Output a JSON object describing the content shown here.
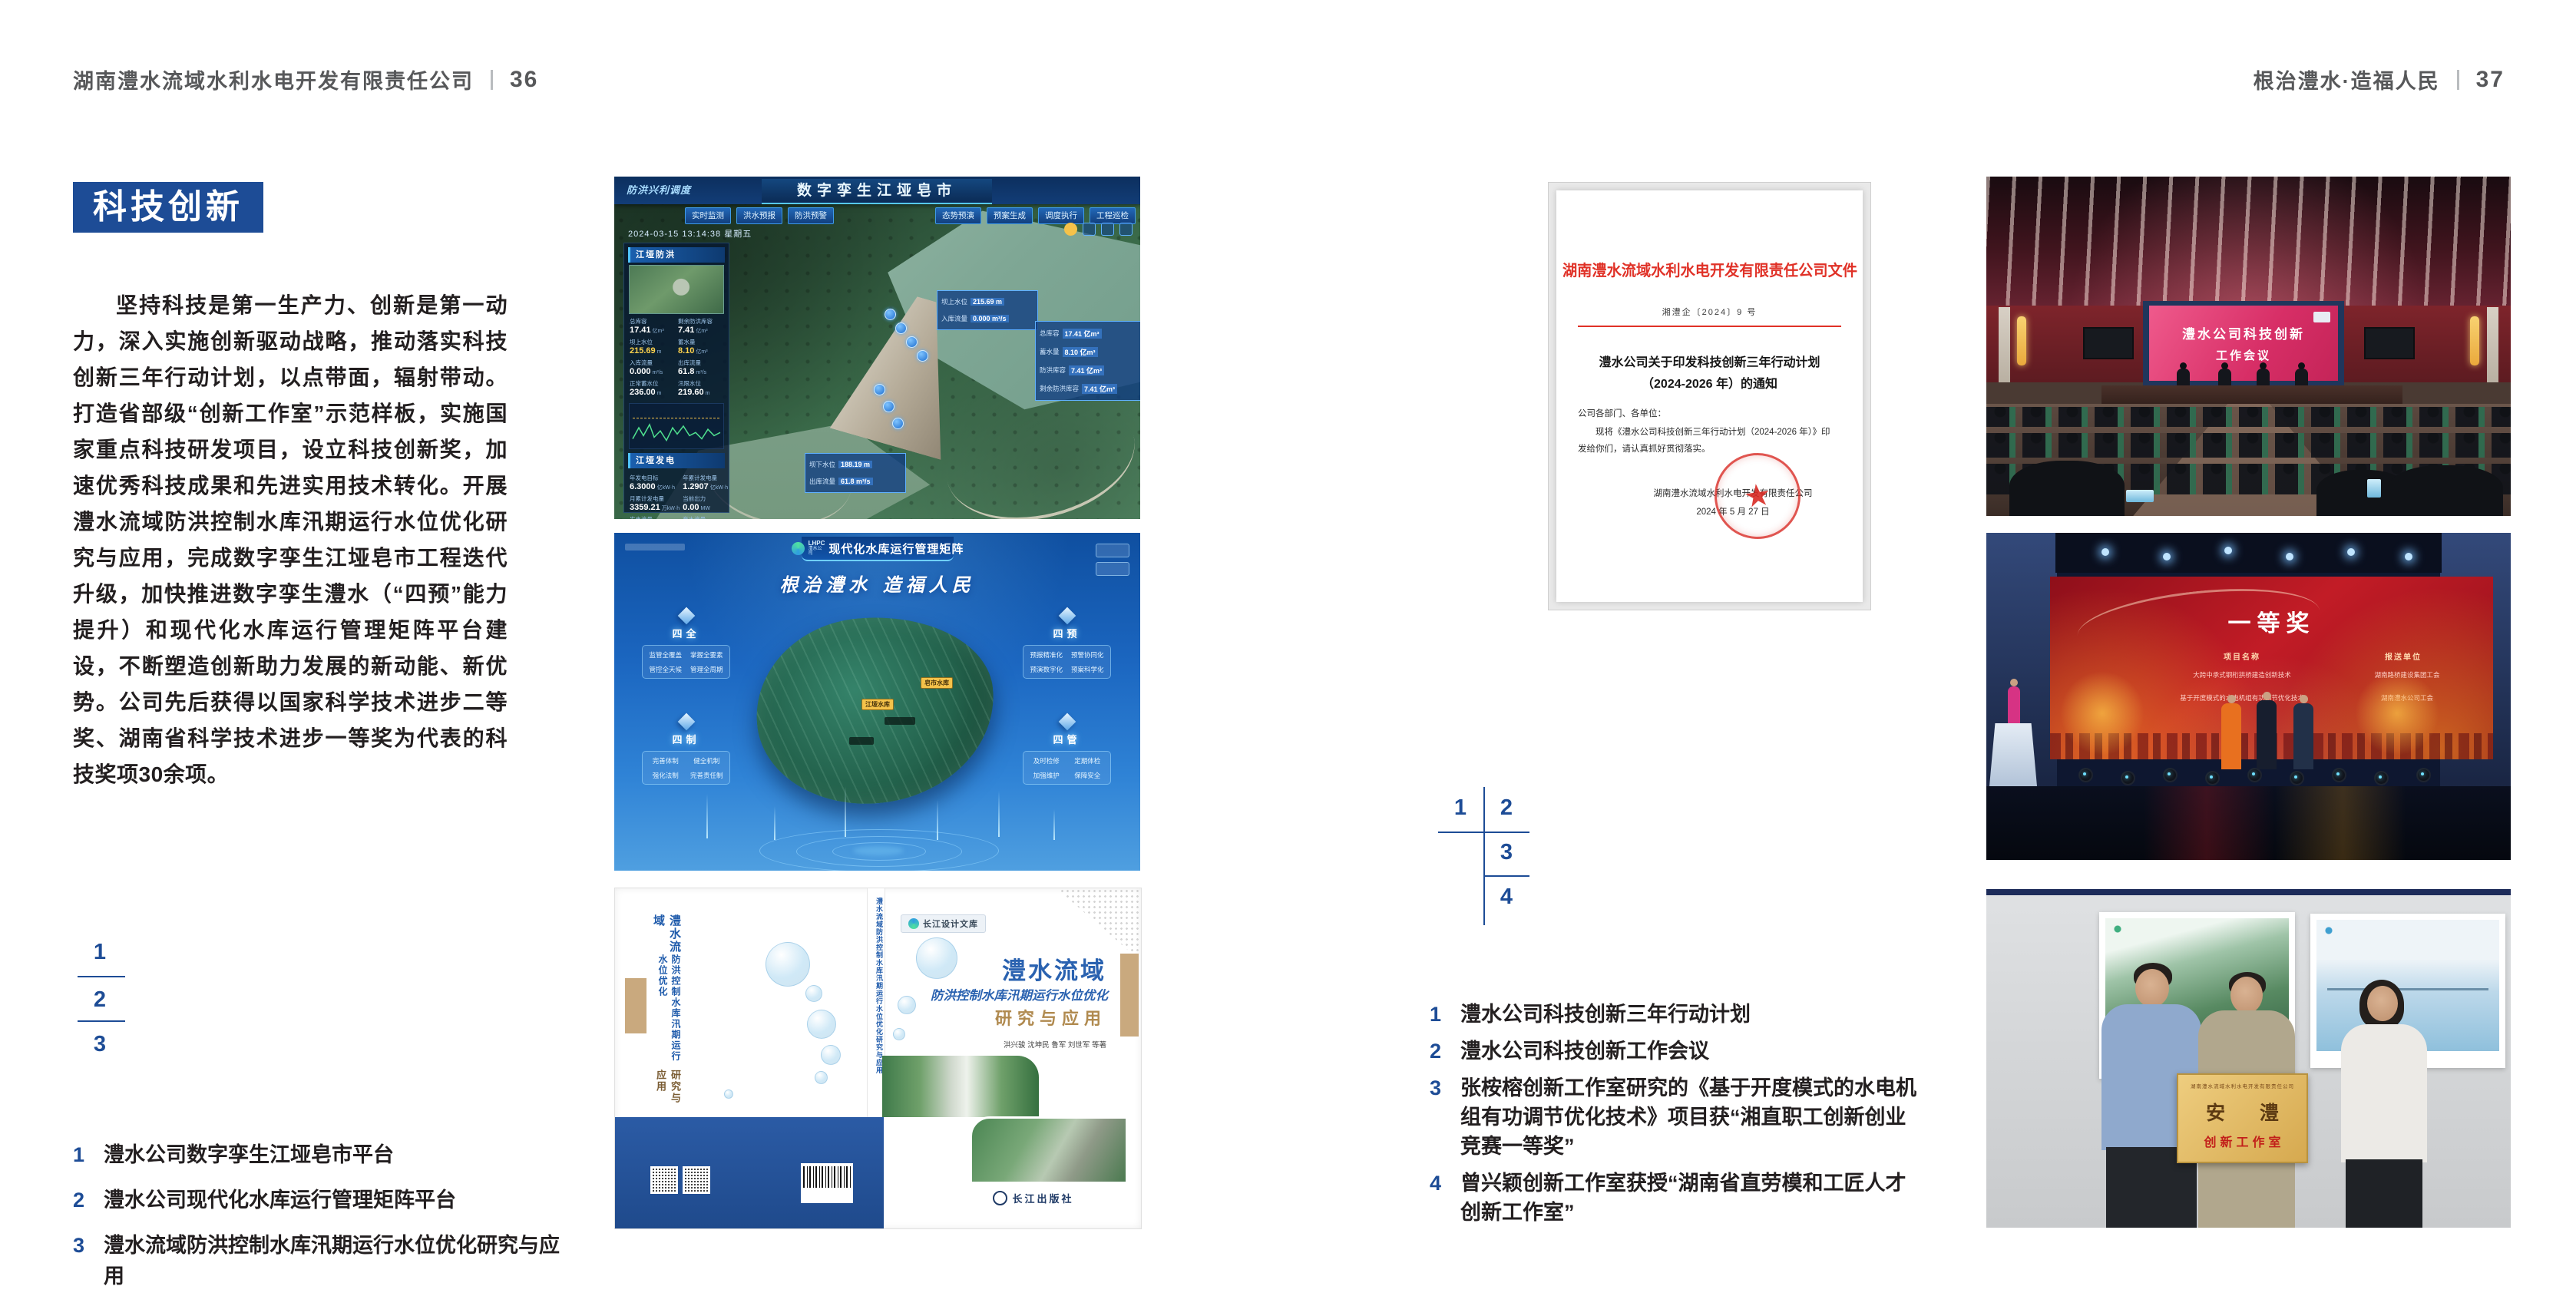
{
  "colors": {
    "accent_blue": "#1d4c96",
    "doc_red": "#e03127",
    "text_dark": "#231f20",
    "header_gray": "#57585a",
    "gold": "#b08a4f"
  },
  "left_page": {
    "header": {
      "company": "湖南澧水流域水利水电开发有限责任公司",
      "page_no": "36"
    },
    "section_title": "科技创新",
    "body_text": "坚持科技是第一生产力、创新是第一动力，深入实施创新驱动战略，推动落实科技创新三年行动计划，以点带面，辐射带动。打造省部级“创新工作室”示范样板，实施国家重点科技研发项目，设立科技创新奖，加速优秀科技成果和先进实用技术转化。开展澧水流域防洪控制水库汛期运行水位优化研究与应用，完成数字孪生江垭皂市工程迭代升级，加快推进数字孪生澧水（“四预”能力提升）和现代化水库运行管理矩阵平台建设，不断塑造创新助力发展的新动能、新优势。公司先后获得以国家科学技术进步二等奖、湖南省科学技术进步一等奖为代表的科技奖项30余项。",
    "key": [
      "1",
      "2",
      "3"
    ],
    "captions": [
      {
        "num": "1",
        "text": "澧水公司数字孪生江垭皂市平台"
      },
      {
        "num": "2",
        "text": "澧水公司现代化水库运行管理矩阵平台"
      },
      {
        "num": "3",
        "text": "澧水流域防洪控制水库汛期运行水位优化研究与应用"
      }
    ]
  },
  "twin": {
    "corner_label": "防洪兴利调度",
    "title": "数字孪生江垭皂市",
    "datetime": "2024-03-15 13:14:38 星期五",
    "tabs_left": [
      "实时监测",
      "洪水预报",
      "防洪预警"
    ],
    "tabs_right": [
      "态势预演",
      "预案生成",
      "调度执行",
      "工程巡检"
    ],
    "panel_flood": {
      "title": "江垭防洪",
      "stats": [
        {
          "l": "总库容",
          "v": "17.41",
          "u": "亿m³"
        },
        {
          "l": "剩余防洪库容",
          "v": "7.41",
          "u": "亿m³"
        },
        {
          "l": "坝上水位",
          "v": "215.69",
          "u": "m"
        },
        {
          "l": "蓄水量",
          "v": "8.10",
          "u": "亿m³"
        },
        {
          "l": "入库流量",
          "v": "0.000",
          "u": "m³/s"
        },
        {
          "l": "出库流量",
          "v": "61.8",
          "u": "m³/s"
        },
        {
          "l": "正常蓄水位",
          "v": "236.00",
          "u": "m"
        },
        {
          "l": "汛限水位",
          "v": "219.60",
          "u": "m"
        }
      ]
    },
    "panel_power": {
      "title": "江垭发电",
      "stats": [
        {
          "l": "年发电目标",
          "v": "6.3000",
          "u": "亿kW·h"
        },
        {
          "l": "年累计发电量",
          "v": "1.2907",
          "u": "亿kW·h"
        },
        {
          "l": "月累计发电量",
          "v": "3359.21",
          "u": "万kW·h"
        },
        {
          "l": "当前出力",
          "v": "0.00",
          "u": "MW"
        },
        {
          "l": "发电流量",
          "v": "0.00",
          "u": "m³/s"
        },
        {
          "l": "弃水流量",
          "v": "0.00",
          "u": "m³/s"
        }
      ]
    },
    "callout_up": {
      "rows": [
        {
          "l": "坝上水位",
          "v": "215.69 m"
        },
        {
          "l": "入库流量",
          "v": "0.000 m³/s"
        }
      ]
    },
    "callout_cap": {
      "rows": [
        {
          "l": "总库容",
          "v": "17.41 亿m³"
        },
        {
          "l": "蓄水量",
          "v": "8.10 亿m³"
        },
        {
          "l": "防洪库容",
          "v": "7.41 亿m³"
        },
        {
          "l": "剩余防洪库容",
          "v": "7.41 亿m³"
        }
      ]
    },
    "callout_down": {
      "rows": [
        {
          "l": "坝下水位",
          "v": "188.19 m"
        },
        {
          "l": "出库流量",
          "v": "61.8 m³/s"
        }
      ]
    }
  },
  "matrix": {
    "logo_text": "LHPC",
    "logo_sub": "澧水公司",
    "title": "现代化水库运行管理矩阵",
    "slogan": "根治澧水 造福人民",
    "tags": [
      "皂市水库",
      "江垭水库"
    ],
    "panels": [
      {
        "name": "四全",
        "items": [
          "监管全覆盖",
          "掌握全要素",
          "管控全天候",
          "管理全周期"
        ]
      },
      {
        "name": "四制",
        "items": [
          "完善体制",
          "健全机制",
          "强化法制",
          "完善责任制"
        ]
      },
      {
        "name": "四预",
        "items": [
          "预报精准化",
          "预警协同化",
          "预演数字化",
          "预案科学化"
        ]
      },
      {
        "name": "四管",
        "items": [
          "及时检修",
          "定期体检",
          "加强维护",
          "保障安全"
        ]
      }
    ]
  },
  "book": {
    "series": "长江设计文库",
    "title1": "澧水流域",
    "title2": "防洪控制水库汛期运行水位优化",
    "title3": "研究与应用",
    "authors": "洪兴骏 沈坤民 鲁军 刘世军 等著",
    "publisher": "长江出版社",
    "spine": "澧水流域防洪控制水库汛期运行水位优化研究与应用",
    "back_title1": "澧水流域",
    "back_title2": "防洪控制水库汛期运行水位优化",
    "back_title3": "研究与应用"
  },
  "right_page": {
    "header": {
      "motto": "根治澧水·造福人民",
      "page_no": "37"
    },
    "document": {
      "title": "湖南澧水流域水利水电开发有限责任公司文件",
      "doc_no": "湘澧企〔2024〕9 号",
      "subject1": "澧水公司关于印发科技创新三年行动计划",
      "subject2": "（2024-2026 年）的通知",
      "salutation": "公司各部门、各单位：",
      "body1": "现将《澧水公司科技创新三年行动计划（2024-2026 年）》印",
      "body2": "发给你们，请认真抓好贯彻落实。",
      "signer": "湖南澧水流域水利水电开发有限责任公司",
      "date": "2024 年 5 月 27 日",
      "seal_star": "★"
    },
    "key": [
      "1",
      "2",
      "3",
      "4"
    ],
    "captions": [
      {
        "num": "1",
        "text": "澧水公司科技创新三年行动计划"
      },
      {
        "num": "2",
        "text": "澧水公司科技创新工作会议"
      },
      {
        "num": "3",
        "text": "张桉榕创新工作室研究的《基于开度模式的水电机组有功调节优化技术》项目获“湘直职工创新创业竞赛一等奖”"
      },
      {
        "num": "4",
        "text": "曾兴颖创新工作室获授“湖南省直劳模和工匠人才创新工作室”"
      }
    ]
  },
  "meeting": {
    "screen1": "澧水公司科技创新",
    "screen2": "工作会议"
  },
  "award": {
    "title": "一等奖",
    "col1": "项目名称",
    "col2": "报送单位",
    "project1": "大跨中承式钢桁拱桥建造创新技术",
    "unit1": "湖南路桥建设集团工会",
    "project2": "基于开度模式的水电机组有功调节优化技术",
    "unit2": "湖南澧水公司工会"
  },
  "plaque": {
    "org": "湖南澧水流域水利水电开发有限责任公司",
    "name": "安 澧",
    "label": "创新工作室"
  }
}
